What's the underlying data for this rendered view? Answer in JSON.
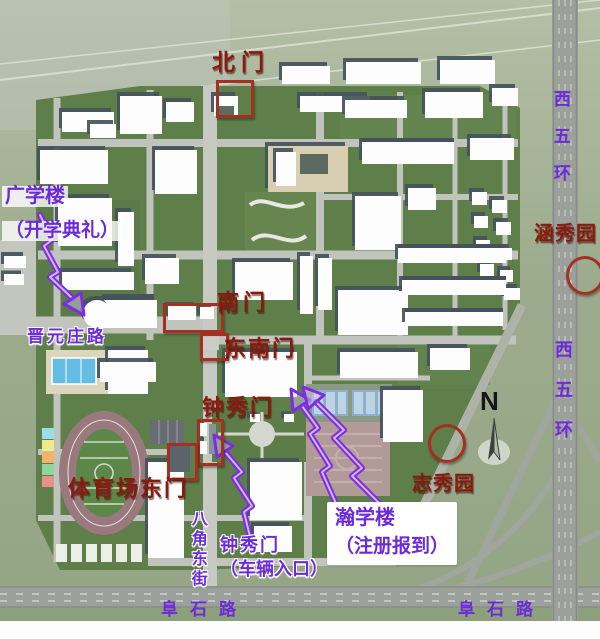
{
  "labels": {
    "north_gate": "北门",
    "south_gate": "南门",
    "southeast_gate": "东南门",
    "zhongxiu_gate": "钟秀门",
    "stadium_east_gate": "体育场东门",
    "hanxiu_garden": "涵秀园",
    "zhixiu_garden": "志秀园",
    "west_fifth_ring": "西五环",
    "jinyuanzhuang_road": "晋元庄路",
    "bajiao_east_street": "八角东街",
    "fushi_road": "阜石路",
    "guangxue_building": "广学楼",
    "guangxue_note": "（开学典礼）",
    "hanxue_building": "瀚学楼",
    "hanxue_note": "（注册报到）",
    "zhongxiu_vehicle_gate": "钟秀门",
    "zhongxiu_vehicle_note": "（车辆入口）",
    "compass_n": "N"
  },
  "colors": {
    "annotation_red": "#8b1a0e",
    "annotation_purple": "#6c2bd9",
    "marker_red": "#a33020",
    "campus_green": "#5e7e4a",
    "road_gray": "#9ba19a"
  }
}
